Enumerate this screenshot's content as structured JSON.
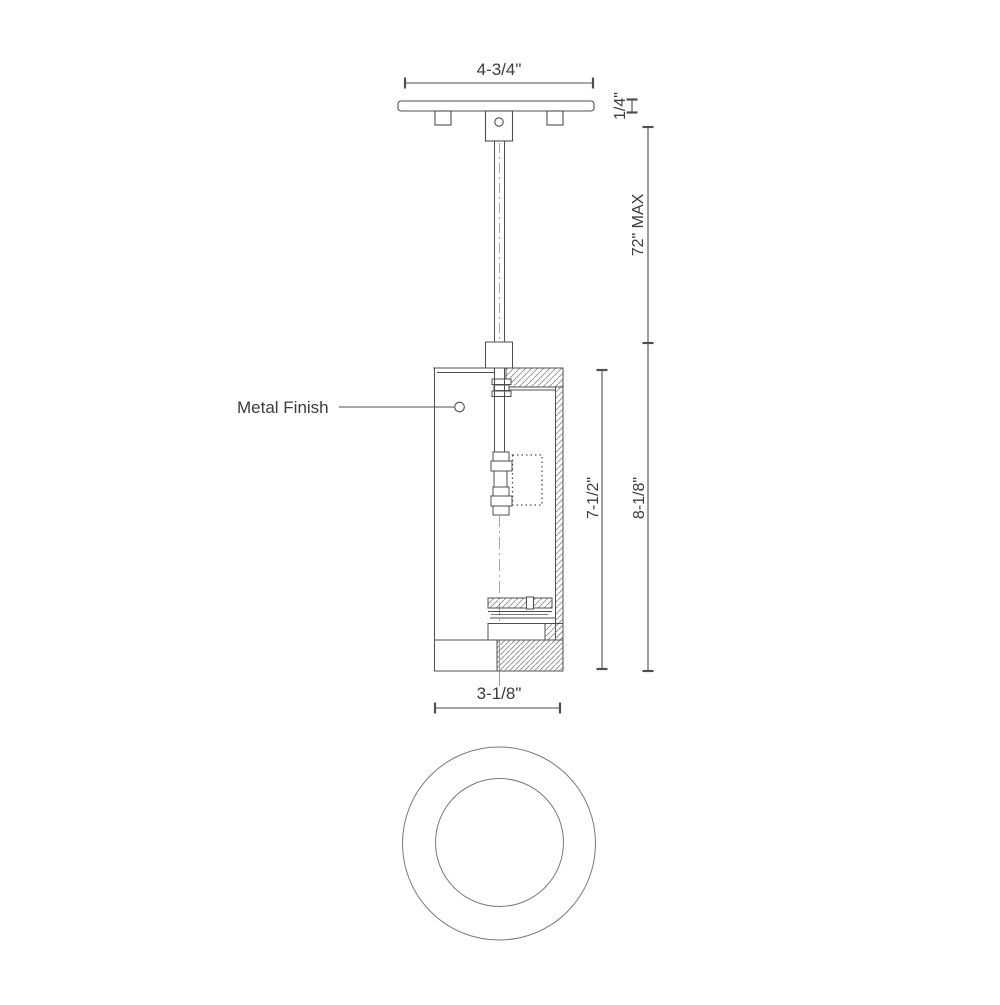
{
  "title": "Pendant light fixture technical line drawing",
  "labels": {
    "metal_finish": "Metal Finish"
  },
  "dimensions": {
    "canopy_width": "4-3/4\"",
    "canopy_thickness": "1/4\"",
    "suspension_max": "72\" MAX",
    "shade_height": "7-1/2\"",
    "fixture_height": "8-1/8\"",
    "shade_diameter": "3-1/8\""
  },
  "colors": {
    "line": "#4f4f4f",
    "hatch": "#8a8a8a",
    "text": "#3c3c3c",
    "background": "#ffffff"
  }
}
